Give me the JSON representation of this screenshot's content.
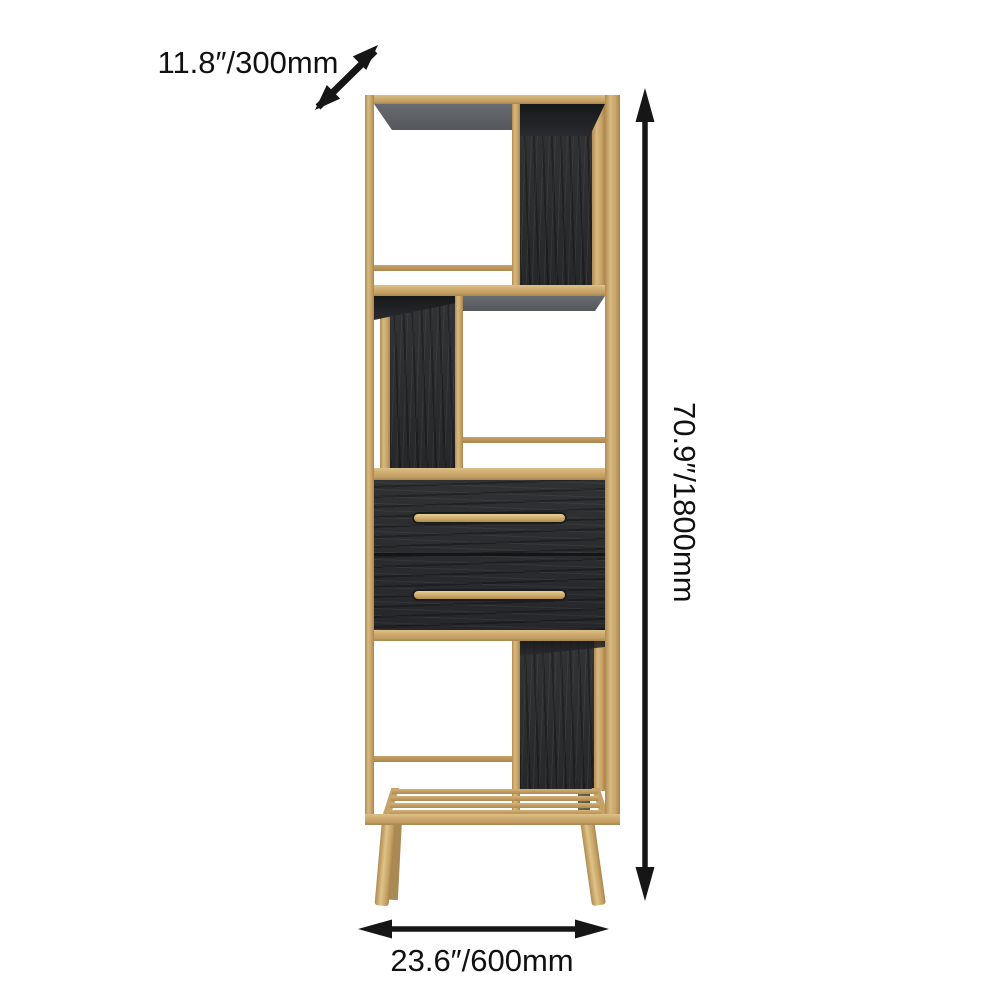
{
  "meta": {
    "alt": "Tall gold metal etagere bookshelf with black wood panels, two drawers with long gold handles, slatted bottom shelf and splayed legs, annotated with dimension arrows"
  },
  "annotations": {
    "depth": {
      "label": "11.8″/300mm",
      "icon": "diagonal-double-arrow-icon"
    },
    "height": {
      "label": "70.9″/1800mm",
      "icon": "vertical-double-arrow-icon"
    },
    "width": {
      "label": "23.6″/600mm",
      "icon": "horizontal-double-arrow-icon"
    }
  },
  "colors": {
    "background": "#ffffff",
    "arrow_and_text": "#161616",
    "frame_gold": "#cda96d",
    "frame_gold_light": "#dcc089",
    "frame_gold_dark": "#a98550",
    "wood_black": "#2c2d2f",
    "underside_gray": "#5d6165",
    "shadow_dark": "#1c1d1f",
    "back_leg_olive": "#5f6149"
  }
}
